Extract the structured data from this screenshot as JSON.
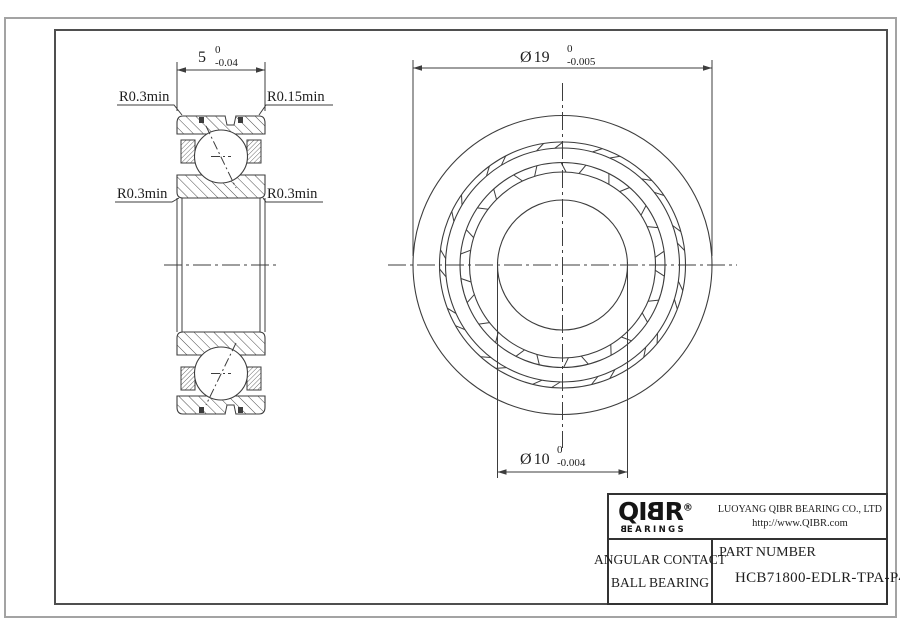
{
  "sheet": {
    "left_view": {
      "width_dim": {
        "nominal": "5",
        "tol_upper": "0",
        "tol_lower": "-0.04"
      },
      "radius_labels": {
        "top_left": "R0.3min",
        "top_right": "R0.15min",
        "bottom_left": "R0.3min",
        "bottom_right": "R0.3min"
      }
    },
    "front_view": {
      "outer_dim": {
        "symbol": "Ø",
        "nominal": "19",
        "tol_upper": "0",
        "tol_lower": "-0.005"
      },
      "bore_dim": {
        "symbol": "Ø",
        "nominal": "10",
        "tol_upper": "0",
        "tol_lower": "-0.004"
      }
    }
  },
  "title_block": {
    "logo": {
      "text_q": "QI",
      "text_b": "B",
      "text_r": "R",
      "registered": "®",
      "sub_b": "B",
      "sub_rest": "EARINGS"
    },
    "company_name": "LUOYANG QIBR BEARING CO., LTD",
    "website": "http://www.QIBR.com",
    "product_type_line1": "ANGULAR CONTACT",
    "product_type_line2": "BALL BEARING",
    "part_number_label": "PART NUMBER",
    "part_number": "HCB71800-EDLR-TPA-P4"
  },
  "colors": {
    "line-color": "#3d3d3d",
    "text-color": "#1e1e1e",
    "frame-outer": "#a3a3a3",
    "frame-inner": "#4f4f4f",
    "bg": "#ffffff"
  }
}
